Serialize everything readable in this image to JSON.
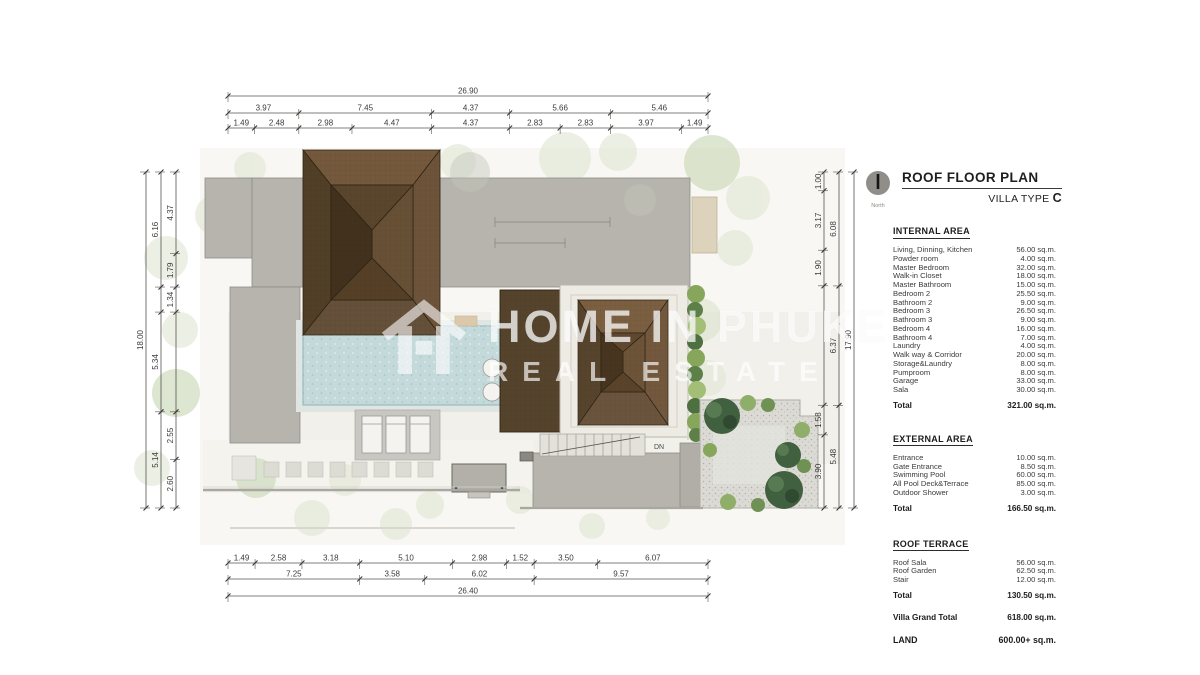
{
  "header": {
    "title": "ROOF FLOOR PLAN",
    "subtitle": "VILLA TYPE",
    "subtitle_suffix": "C",
    "compass_label": "North"
  },
  "internal": {
    "heading": "INTERNAL AREA",
    "rows": [
      [
        "Living, Dinning, Kitchen",
        "56.00 sq.m."
      ],
      [
        "Powder room",
        "4.00 sq.m."
      ],
      [
        "Master Bedroom",
        "32.00 sq.m."
      ],
      [
        "Walk-in Closet",
        "18.00 sq.m."
      ],
      [
        "Master Bathroom",
        "15.00 sq.m."
      ],
      [
        "Bedroom 2",
        "25.50 sq.m."
      ],
      [
        "Bathroom 2",
        "9.00 sq.m."
      ],
      [
        "Bedroom 3",
        "26.50 sq.m."
      ],
      [
        "Bathroom 3",
        "9.00 sq.m."
      ],
      [
        "Bedroom 4",
        "16.00 sq.m."
      ],
      [
        "Bathroom 4",
        "7.00 sq.m."
      ],
      [
        "Laundry",
        "4.00 sq.m."
      ],
      [
        "Walk way & Corridor",
        "20.00 sq.m."
      ],
      [
        "Storage&Laundry",
        "8.00 sq.m."
      ],
      [
        "Pumproom",
        "8.00 sq.m."
      ],
      [
        "Garage",
        "33.00 sq.m."
      ],
      [
        "Sala",
        "30.00 sq.m."
      ]
    ],
    "total_label": "Total",
    "total": "321.00 sq.m."
  },
  "external": {
    "heading": "EXTERNAL AREA",
    "rows": [
      [
        "Entrance",
        "10.00 sq.m."
      ],
      [
        "Gate Entrance",
        "8.50 sq.m."
      ],
      [
        "Swimming Pool",
        "60.00 sq.m."
      ],
      [
        "All Pool Deck&Terrace",
        "85.00 sq.m."
      ],
      [
        "Outdoor Shower",
        "3.00 sq.m."
      ]
    ],
    "total_label": "Total",
    "total": "166.50 sq.m."
  },
  "terrace": {
    "heading": "ROOF TERRACE",
    "rows": [
      [
        "Roof Sala",
        "56.00 sq.m."
      ],
      [
        "Roof Garden",
        "62.50 sq.m."
      ],
      [
        "Stair",
        "12.00 sq.m."
      ]
    ],
    "total_label": "Total",
    "total": "130.50 sq.m."
  },
  "grand": {
    "label": "Villa Grand Total",
    "value": "618.00 sq.m."
  },
  "land": {
    "label": "LAND",
    "value": "600.00+ sq.m."
  },
  "watermark": {
    "line1": "HOME IN PHUKET",
    "line2": "REAL ESTATE"
  },
  "plan_labels": {
    "stair": "DN"
  },
  "colors": {
    "roof_brown_dark": "#46351f",
    "roof_brown": "#6a5339",
    "flat_roof_gray": "#b6b4ad",
    "pool_blue": "#c3d9da",
    "hedge_green": "#86a75b",
    "tree_dark_green": "#41603f",
    "gravel": "#dbdad4"
  },
  "dims": {
    "top": {
      "x0": 228,
      "x1": 708,
      "rows": [
        {
          "y": 96,
          "items": [
            {
              "v": "26.90",
              "m": 26.91
            }
          ]
        },
        {
          "y": 113,
          "items": [
            {
              "v": "3.97",
              "m": 3.97
            },
            {
              "v": "7.45",
              "m": 7.45
            },
            {
              "v": "4.37",
              "m": 4.37
            },
            {
              "v": "5.66",
              "m": 5.66
            },
            {
              "v": "5.46",
              "m": 5.46
            }
          ]
        },
        {
          "y": 128,
          "items": [
            {
              "v": "1.49",
              "m": 1.49
            },
            {
              "v": "2.48",
              "m": 2.48
            },
            {
              "v": "2.98",
              "m": 2.98
            },
            {
              "v": "4.47",
              "m": 4.47
            },
            {
              "v": "4.37",
              "m": 4.37
            },
            {
              "v": "2.83",
              "m": 2.83
            },
            {
              "v": "2.83",
              "m": 2.83
            },
            {
              "v": "3.97",
              "m": 3.97
            },
            {
              "v": "1.49",
              "m": 1.49
            }
          ]
        }
      ]
    },
    "bottom": {
      "x0": 228,
      "x1": 708,
      "rows": [
        {
          "y": 563,
          "items": [
            {
              "v": "1.49",
              "m": 1.49
            },
            {
              "v": "2.58",
              "m": 2.58
            },
            {
              "v": "3.18",
              "m": 3.18
            },
            {
              "v": "5.10",
              "m": 5.1
            },
            {
              "v": "2.98",
              "m": 2.98
            },
            {
              "v": "1.52",
              "m": 1.52
            },
            {
              "v": "3.50",
              "m": 3.5
            },
            {
              "v": "6.07",
              "m": 6.07
            }
          ]
        },
        {
          "y": 579,
          "items": [
            {
              "v": "7.25",
              "m": 7.25
            },
            {
              "v": "3.58",
              "m": 3.58
            },
            {
              "v": "6.02",
              "m": 6.02
            },
            {
              "v": "9.57",
              "m": 9.57
            }
          ]
        },
        {
          "y": 596,
          "items": [
            {
              "v": "26.40",
              "m": 26.4
            }
          ]
        }
      ]
    },
    "left": {
      "y0": 172,
      "y1": 508,
      "cols": [
        {
          "x": 146,
          "items": [
            {
              "v": "18.00",
              "m": 17.99
            }
          ]
        },
        {
          "x": 161,
          "items": [
            {
              "v": "6.16",
              "m": 6.16
            },
            {
              "v": "",
              "m": 1.34
            },
            {
              "v": "5.34",
              "m": 5.34
            },
            {
              "v": "5.14",
              "m": 5.15
            }
          ]
        },
        {
          "x": 176,
          "items": [
            {
              "v": "4.37",
              "m": 4.37
            },
            {
              "v": "1.79",
              "m": 1.79
            },
            {
              "v": "1.34",
              "m": 1.34
            },
            {
              "v": "",
              "m": 5.34
            },
            {
              "v": "2.55",
              "m": 2.55
            },
            {
              "v": "2.60",
              "m": 2.6
            }
          ]
        }
      ]
    },
    "right": {
      "y0": 172,
      "y1": 508,
      "cols": [
        {
          "x": 824,
          "items": [
            {
              "v": "1.00",
              "m": 1.0
            },
            {
              "v": "3.17",
              "m": 3.17
            },
            {
              "v": "1.90",
              "m": 1.9
            },
            {
              "v": "",
              "m": 6.37
            },
            {
              "v": "1.58",
              "m": 1.58
            },
            {
              "v": "3.90",
              "m": 3.9
            }
          ]
        },
        {
          "x": 839,
          "items": [
            {
              "v": "6.08",
              "m": 6.08
            },
            {
              "v": "6.37",
              "m": 6.37
            },
            {
              "v": "5.48",
              "m": 5.48
            }
          ]
        },
        {
          "x": 854,
          "items": [
            {
              "v": "17.90",
              "m": 17.92
            }
          ]
        }
      ]
    }
  }
}
